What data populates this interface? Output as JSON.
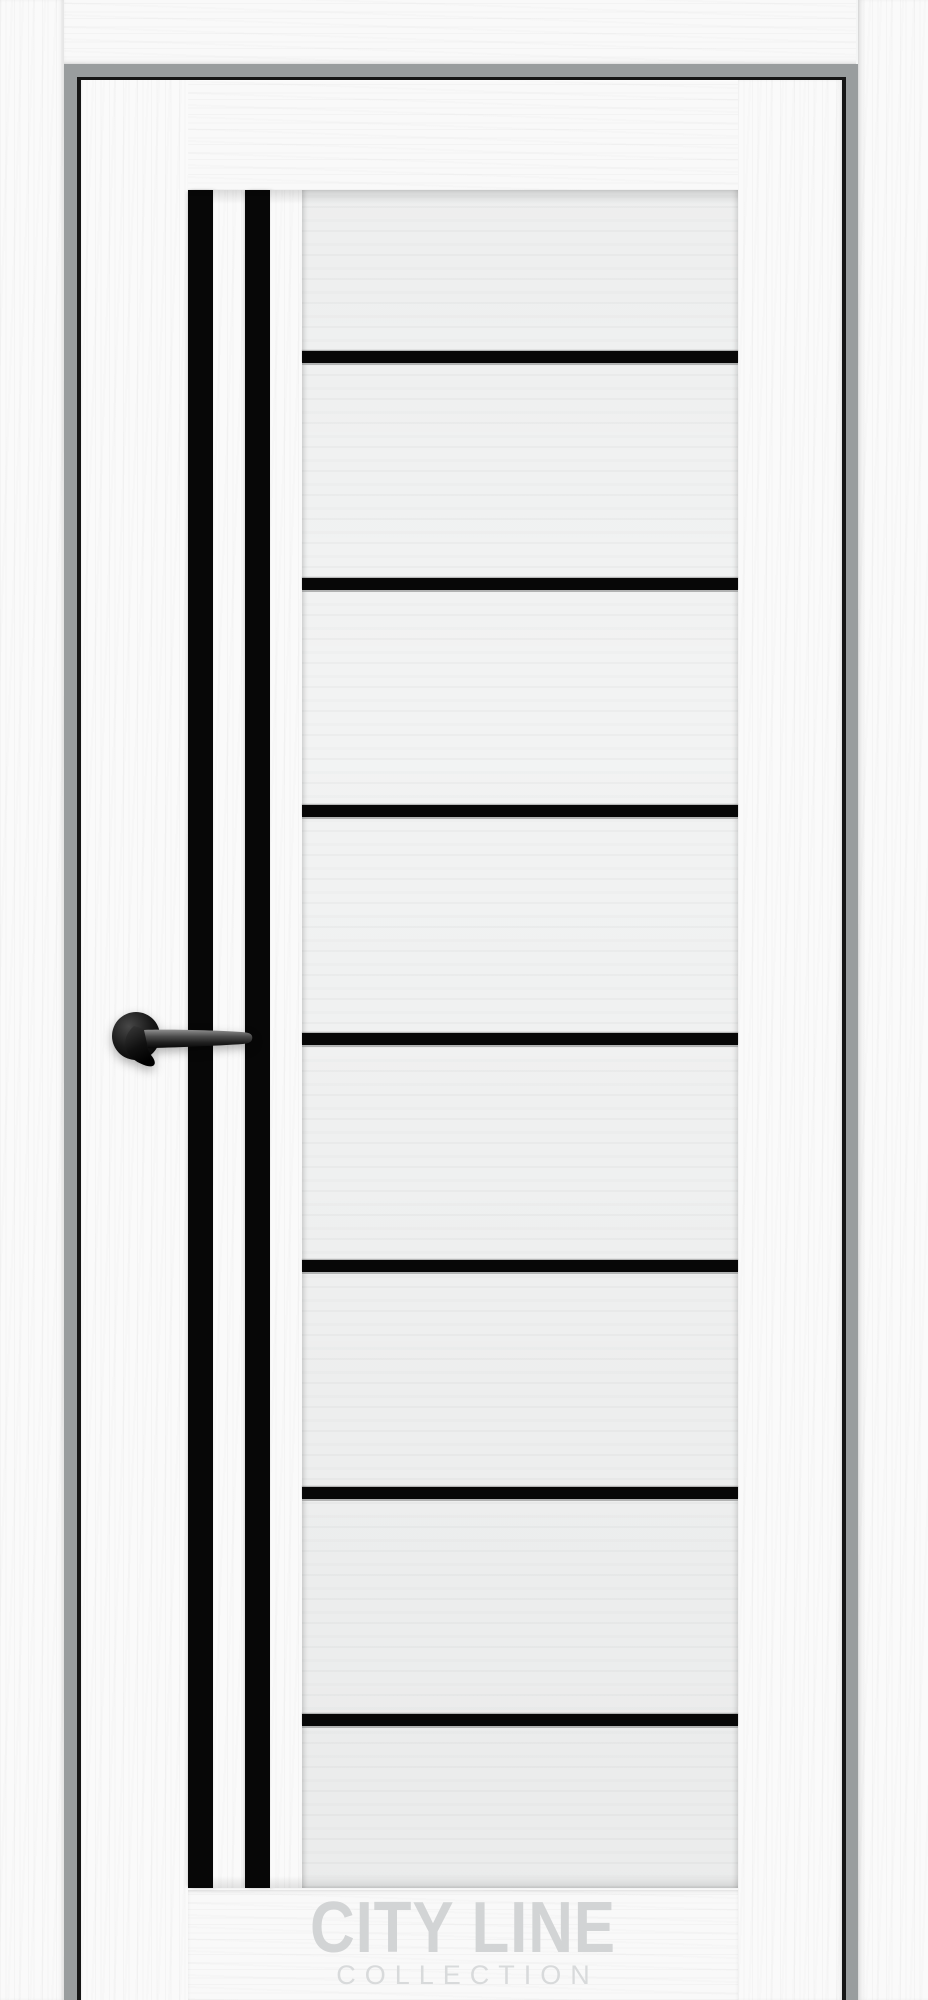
{
  "photo": {
    "subject": "white interior door with black glass inserts, product photo",
    "watermark": {
      "brand": "CITY LINE",
      "sub": "COLLECTION"
    },
    "door": {
      "finish": "white ash woodgrain",
      "vertical_inserts": 2,
      "horizontal_inserts": 7,
      "handle": "black lever handle on round rosette"
    },
    "colors": {
      "casing_white": "#fafafa",
      "leaf_white": "#f9f9f9",
      "glass_tint": "#f2f3f3",
      "insert_black": "#070707",
      "jamb_gray": "#999d9e",
      "gap_black": "#161616",
      "watermark_gray": "#d2d4d5"
    }
  }
}
